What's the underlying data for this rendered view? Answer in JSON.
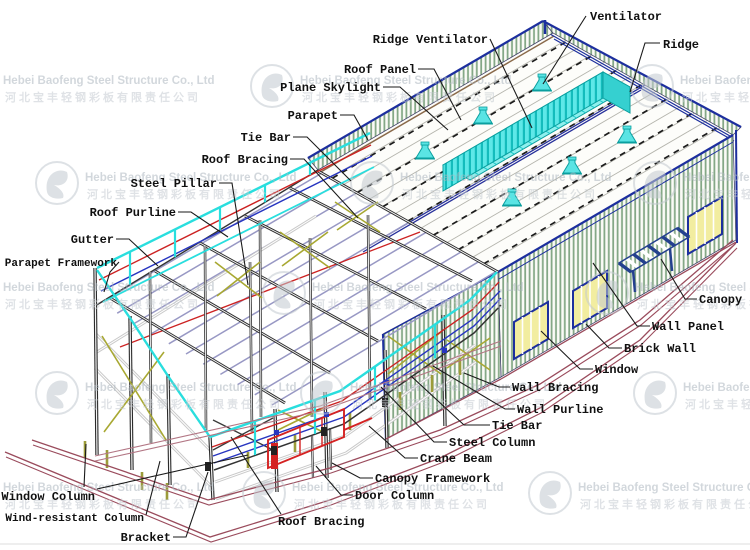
{
  "watermark": {
    "company_en": "Hebei Baofeng Steel Structure Co., Ltd",
    "company_cn": "河北宝丰轻钢彩板有限责任公司",
    "logo": "baofeng-circle-logo",
    "rows": [
      {
        "y": 74,
        "xs": [
          -47,
          250,
          630
        ]
      },
      {
        "y": 171,
        "xs": [
          35,
          350,
          633
        ]
      },
      {
        "y": 281,
        "xs": [
          -47,
          262,
          585
        ]
      },
      {
        "y": 381,
        "xs": [
          35,
          300,
          633
        ]
      },
      {
        "y": 481,
        "xs": [
          -47,
          242,
          528
        ]
      }
    ]
  },
  "diagram": {
    "subject": "Isometric cutaway diagram of a light steel structure workshop building",
    "labels": [
      {
        "id": "ventilator",
        "text": "Ventilator",
        "x": 590,
        "y": 20,
        "anchor": "start",
        "size": 12,
        "leaders": [
          [
            [
              586,
              16
            ],
            [
              543,
              84
            ]
          ]
        ]
      },
      {
        "id": "ridge",
        "text": "Ridge",
        "x": 663,
        "y": 48,
        "anchor": "start",
        "size": 12,
        "leaders": [
          [
            [
              660,
              43
            ],
            [
              645,
              43
            ],
            [
              630,
              92
            ]
          ]
        ]
      },
      {
        "id": "ridge-ventilator",
        "text": "Ridge Ventilator",
        "x": 488,
        "y": 43,
        "anchor": "end",
        "size": 12,
        "leaders": [
          [
            [
              490,
              39
            ],
            [
              532,
              128
            ]
          ]
        ]
      },
      {
        "id": "roof-panel",
        "text": "Roof Panel",
        "x": 416,
        "y": 73,
        "anchor": "end",
        "size": 12,
        "leaders": [
          [
            [
              418,
              69
            ],
            [
              434,
              69
            ],
            [
              461,
              120
            ]
          ]
        ]
      },
      {
        "id": "plane-skylight",
        "text": "Plane Skylight",
        "x": 381,
        "y": 91,
        "anchor": "end",
        "size": 12,
        "leaders": [
          [
            [
              383,
              87
            ],
            [
              400,
              87
            ],
            [
              448,
              130
            ]
          ]
        ]
      },
      {
        "id": "parapet",
        "text": "Parapet",
        "x": 338,
        "y": 119,
        "anchor": "end",
        "size": 12,
        "leaders": [
          [
            [
              340,
              115
            ],
            [
              354,
              115
            ],
            [
              368,
              140
            ]
          ]
        ]
      },
      {
        "id": "tie-bar-top",
        "text": "Tie Bar",
        "x": 291,
        "y": 141,
        "anchor": "end",
        "size": 12,
        "leaders": [
          [
            [
              293,
              137
            ],
            [
              307,
              137
            ],
            [
              351,
              181
            ]
          ]
        ]
      },
      {
        "id": "roof-bracing-top",
        "text": "Roof Bracing",
        "x": 288,
        "y": 163,
        "anchor": "end",
        "size": 12,
        "leaders": [
          [
            [
              290,
              159
            ],
            [
              304,
              159
            ],
            [
              358,
              218
            ]
          ]
        ]
      },
      {
        "id": "steel-pillar",
        "text": "Steel Pillar",
        "x": 217,
        "y": 187,
        "anchor": "end",
        "size": 12,
        "leaders": [
          [
            [
              219,
              183
            ],
            [
              232,
              183
            ],
            [
              248,
              285
            ]
          ]
        ]
      },
      {
        "id": "roof-purline",
        "text": "Roof Purline",
        "x": 176,
        "y": 216,
        "anchor": "end",
        "size": 12,
        "leaders": [
          [
            [
              178,
              212
            ],
            [
              191,
              212
            ],
            [
              228,
              237
            ]
          ]
        ]
      },
      {
        "id": "gutter",
        "text": "Gutter",
        "x": 114,
        "y": 243,
        "anchor": "end",
        "size": 12,
        "leaders": [
          [
            [
              116,
              239
            ],
            [
              129,
              239
            ],
            [
              158,
              266
            ]
          ]
        ]
      },
      {
        "id": "parapet-framework",
        "text": "Parapet Framework",
        "x": 117,
        "y": 266,
        "anchor": "end",
        "size": 11,
        "leaders": [
          [
            [
              119,
              262
            ],
            [
              110,
              272
            ],
            [
              104,
              292
            ]
          ]
        ]
      },
      {
        "id": "window-column",
        "text": "Window Column",
        "x": 95,
        "y": 500,
        "anchor": "end",
        "size": 12,
        "leaders": [
          [
            [
              97,
              489
            ],
            [
              248,
              455
            ]
          ],
          [
            [
              84,
              487
            ],
            [
              86,
              444
            ]
          ]
        ]
      },
      {
        "id": "wind-resistant-column",
        "text": "Wind-resistant Column",
        "x": 144,
        "y": 521,
        "anchor": "end",
        "size": 11,
        "leaders": [
          [
            [
              146,
              515
            ],
            [
              160,
              461
            ]
          ]
        ]
      },
      {
        "id": "bracket",
        "text": "Bracket",
        "x": 171,
        "y": 541,
        "anchor": "end",
        "size": 12,
        "leaders": [
          [
            [
              173,
              537
            ],
            [
              186,
              537
            ],
            [
              208,
              472
            ]
          ]
        ]
      },
      {
        "id": "roof-bracing-bottom",
        "text": "Roof Bracing",
        "x": 278,
        "y": 525,
        "anchor": "start",
        "size": 12,
        "leaders": [
          [
            [
              281,
              514
            ],
            [
              231,
              437
            ]
          ]
        ]
      },
      {
        "id": "door-column",
        "text": "Door Column",
        "x": 355,
        "y": 499,
        "anchor": "start",
        "size": 12,
        "leaders": [
          [
            [
              353,
              495
            ],
            [
              341,
              495
            ],
            [
              316,
              466
            ]
          ]
        ]
      },
      {
        "id": "canopy-framework",
        "text": "Canopy Framework",
        "x": 375,
        "y": 482,
        "anchor": "start",
        "size": 12,
        "leaders": [
          [
            [
              373,
              478
            ],
            [
              360,
              478
            ],
            [
              332,
              463
            ]
          ]
        ]
      },
      {
        "id": "crane-beam",
        "text": "Crane Beam",
        "x": 420,
        "y": 462,
        "anchor": "start",
        "size": 12,
        "leaders": [
          [
            [
              418,
              458
            ],
            [
              405,
              458
            ],
            [
              369,
              426
            ]
          ]
        ]
      },
      {
        "id": "steel-column",
        "text": "Steel Column",
        "x": 449,
        "y": 446,
        "anchor": "start",
        "size": 12,
        "leaders": [
          [
            [
              447,
              442
            ],
            [
              434,
              442
            ],
            [
              381,
              387
            ]
          ]
        ]
      },
      {
        "id": "tie-bar-bottom",
        "text": "Tie Bar",
        "x": 492,
        "y": 429,
        "anchor": "start",
        "size": 12,
        "leaders": [
          [
            [
              490,
              425
            ],
            [
              464,
              425
            ],
            [
              411,
              376
            ]
          ]
        ]
      },
      {
        "id": "wall-purline",
        "text": "Wall Purline",
        "x": 517,
        "y": 413,
        "anchor": "start",
        "size": 12,
        "leaders": [
          [
            [
              515,
              409
            ],
            [
              505,
              409
            ],
            [
              433,
              366
            ]
          ]
        ]
      },
      {
        "id": "wall-bracing",
        "text": "Wall Bracing",
        "x": 512,
        "y": 391,
        "anchor": "start",
        "size": 12,
        "leaders": [
          [
            [
              510,
              387
            ],
            [
              499,
              387
            ],
            [
              464,
              373
            ]
          ]
        ]
      },
      {
        "id": "window",
        "text": "Window",
        "x": 595,
        "y": 373,
        "anchor": "start",
        "size": 12,
        "leaders": [
          [
            [
              593,
              369
            ],
            [
              580,
              369
            ],
            [
              541,
              331
            ]
          ]
        ]
      },
      {
        "id": "brick-wall",
        "text": "Brick Wall",
        "x": 624,
        "y": 352,
        "anchor": "start",
        "size": 12,
        "leaders": [
          [
            [
              622,
              348
            ],
            [
              609,
              348
            ],
            [
              586,
              324
            ]
          ]
        ]
      },
      {
        "id": "wall-panel",
        "text": "Wall Panel",
        "x": 652,
        "y": 330,
        "anchor": "start",
        "size": 12,
        "leaders": [
          [
            [
              650,
              326
            ],
            [
              637,
              326
            ],
            [
              593,
              263
            ]
          ]
        ]
      },
      {
        "id": "canopy",
        "text": "Canopy",
        "x": 699,
        "y": 303,
        "anchor": "start",
        "size": 12,
        "leaders": [
          [
            [
              697,
              299
            ],
            [
              685,
              299
            ],
            [
              661,
              259
            ]
          ]
        ]
      }
    ]
  },
  "colors": {
    "accent_cyan": "#35dede",
    "frame_dark": "#2b2b2b",
    "purlin_lavender": "#9898c4",
    "wall_stripe_green": "#84a886",
    "trim_navy": "#1d2f9e",
    "crane_red": "#d42222",
    "bracing_yellow": "#a8a832",
    "plinth_maroon": "#9a4b5c",
    "window_yellow": "#f2eda0",
    "gutter_brown": "#8a6a4a"
  }
}
